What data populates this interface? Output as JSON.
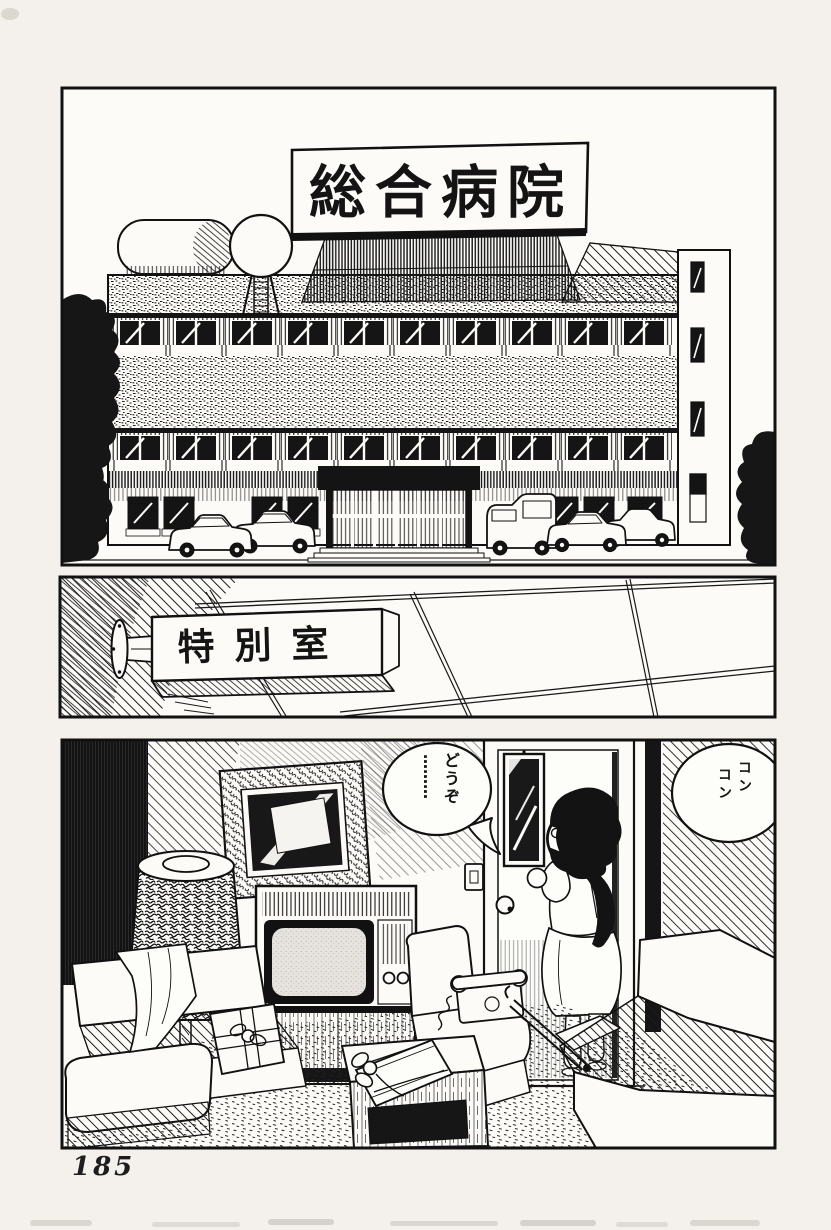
{
  "page": {
    "number": "185",
    "paper_color": "#f4f1ec",
    "panel_bg_color": "#fcfbf8",
    "ink_color": "#1a1a1a"
  },
  "panels": {
    "hospital_exterior": {
      "description": "hospital building exterior with rooftop billboard, water tower, tank, parked cars and trees",
      "sign_text": "総合病院"
    },
    "corridor_sign": {
      "description": "room nameplate mounted on corridor wall under ceiling tiles",
      "sign_text": "特別室"
    },
    "room_interior": {
      "description": "hospital room with lamp, picture frame, TV, sofas, table; nurse knocking at door",
      "speech_bubble": {
        "col1": "どうぞ",
        "col2": "………"
      },
      "sfx_bubble": {
        "col1": "コン",
        "col2": "コン"
      }
    }
  }
}
